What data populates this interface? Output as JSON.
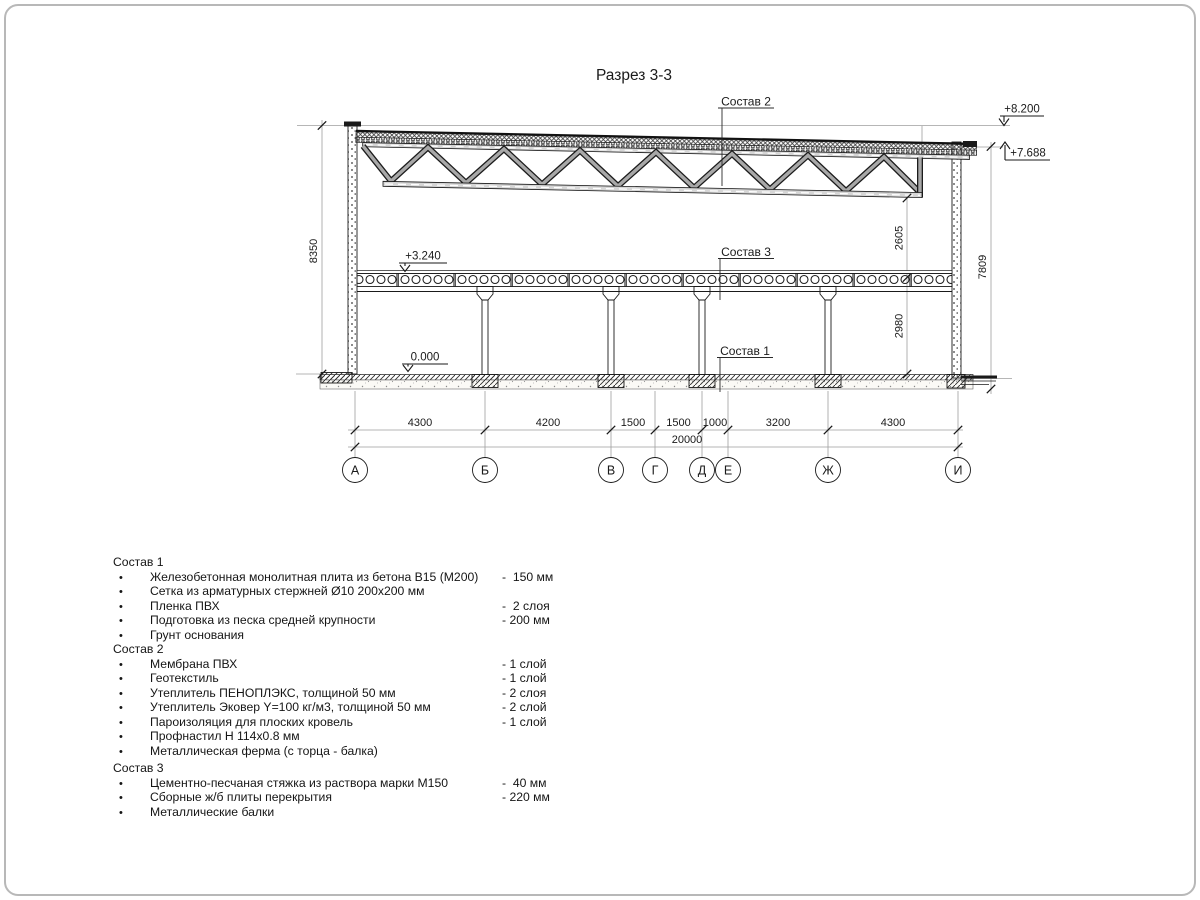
{
  "title": "Разрез 3-3",
  "colors": {
    "line": "#1a1a1a",
    "construction_line": "#9e9e9e",
    "background": "#ffffff",
    "sheet_border": "#b8b8b8"
  },
  "drawing": {
    "labels": {
      "sostav1": "Состав 1",
      "sostav2": "Состав 2",
      "sostav3": "Состав 3"
    },
    "elevations": {
      "parapet": "+8.200",
      "roof": "+7.688",
      "floor": "+3.240",
      "ground": "0.000"
    },
    "dims_vertical": {
      "left": "8350",
      "truss": "2605",
      "floor": "2980",
      "right": "7809"
    },
    "dims_horizontal": [
      "4300",
      "4200",
      "1500",
      "1500",
      "1000",
      "3200",
      "4300"
    ],
    "dim_total": "20000",
    "axes": [
      "А",
      "Б",
      "В",
      "Г",
      "Д",
      "Е",
      "Ж",
      "И"
    ]
  },
  "legend": {
    "bullet": "•",
    "sections": [
      {
        "heading": "Состав 1",
        "items": [
          {
            "name": "Железобетонная монолитная плита из бетона В15 (М200)",
            "value": "-  150 мм"
          },
          {
            "name": "Сетка из арматурных стержней Ø10 200x200 мм",
            "value": ""
          },
          {
            "name": "Пленка ПВХ",
            "value": "-  2 слоя"
          },
          {
            "name": "Подготовка из песка средней крупности",
            "value": "- 200 мм"
          },
          {
            "name": "Грунт основания",
            "value": ""
          }
        ]
      },
      {
        "heading": "Состав 2",
        "items": [
          {
            "name": "Мембрана ПВХ",
            "value": "- 1 слой"
          },
          {
            "name": "Геотекстиль",
            "value": "- 1 слой"
          },
          {
            "name": "Утеплитель ПЕНОПЛЭКС, толщиной 50 мм",
            "value": "- 2 слоя"
          },
          {
            "name": "Утеплитель Эковер Y=100 кг/м3, толщиной 50 мм",
            "value": "- 2 слой"
          },
          {
            "name": "Пароизоляция для плоских кровель",
            "value": "- 1 слой"
          },
          {
            "name": "Профнастил Н 114x0.8 мм",
            "value": ""
          },
          {
            "name": "Металлическая ферма (с торца - балка)",
            "value": ""
          }
        ]
      },
      {
        "heading": "Состав 3",
        "items": [
          {
            "name": "Цементно-песчаная стяжка из раствора марки М150",
            "value": "-  40 мм"
          },
          {
            "name": "Сборные ж/б плиты перекрытия",
            "value": "- 220 мм"
          },
          {
            "name": "Металлические балки",
            "value": ""
          }
        ]
      }
    ]
  }
}
